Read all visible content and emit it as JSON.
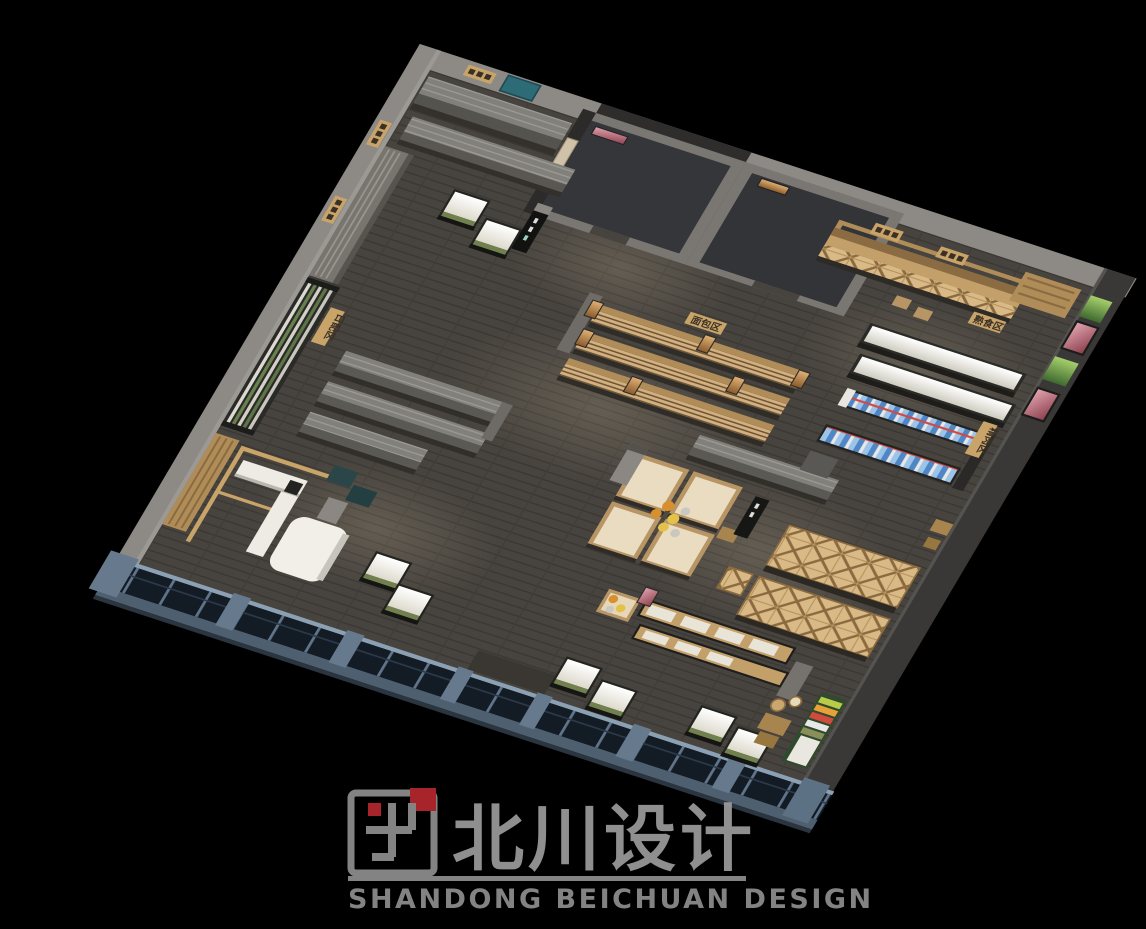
{
  "watermark": {
    "title": "北川设计",
    "subtitle": "SHANDONG BEICHUAN DESIGN"
  },
  "signs": {
    "dairy": "日配区",
    "bakery": "面包区",
    "deli": "熟食区",
    "meat": "精肉区"
  },
  "scene": {
    "subject": "Bird's-eye 3D render of a supermarket interior layout",
    "colors": {
      "background": "#000000",
      "floor": "#47433e",
      "wall_light": "#8d8a86",
      "wall_dark": "#3a3836",
      "storefront_blue": "#66798d",
      "wood": "#c9a76f",
      "door_teal": "#2d6b77",
      "logo_red": "#b5282e",
      "watermark_gray": "#8f8f8f"
    }
  }
}
